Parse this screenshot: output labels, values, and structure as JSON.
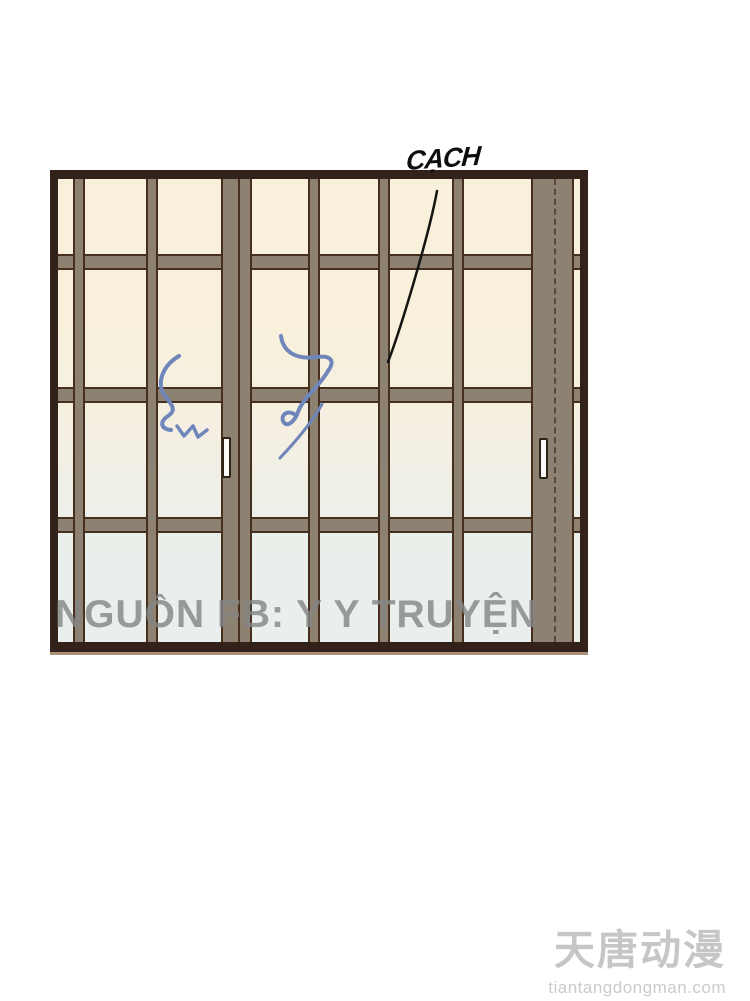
{
  "panel": {
    "sfx": {
      "text": "CẠCH"
    },
    "watermark": {
      "text": "NGUỒN FB: Y Y TRUYỆN"
    },
    "colors": {
      "frame": "#32221a",
      "frame_track": "#ab9177",
      "mullion": "#8d8172",
      "mullion_outline": "#46301d",
      "glass_top": "#f8f0da",
      "glass_mid": "#f4efe2",
      "glass_bottom": "#e8efec",
      "handle": "#fbfbf9",
      "motion_mark": "#6f86bb",
      "sfx_line": "#141414",
      "watermark_gray": "#858585",
      "logo_gray": "#c6c6c6"
    }
  },
  "footer_logo": {
    "brand": "天唐动漫",
    "domain": "tiantangdongman.com"
  }
}
